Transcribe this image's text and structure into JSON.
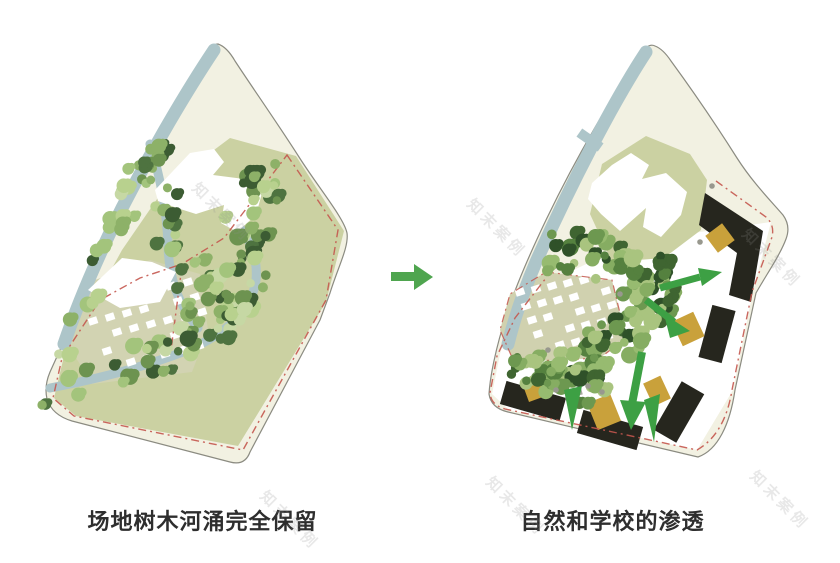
{
  "panels": {
    "left": {
      "caption": "场地树木河涌完全保留"
    },
    "right": {
      "caption": "自然和学校的渗透"
    }
  },
  "arrow": {
    "direction": "right"
  },
  "watermark": {
    "text": "知末案例"
  },
  "colors": {
    "site_fill": "#f2f1e2",
    "site_outline": "#8b8b81",
    "olive": "#cbd1a2",
    "village_ground_left": "#d2d3b2",
    "village_ground_right": "#d0d1af",
    "river": "#adc5c9",
    "building_white": "#ffffff",
    "building_black": "#26261e",
    "courtyard_gold": "#c9a13b",
    "boundary_red": "#c4574e",
    "arrow_green": "#4fa54f",
    "plan_arrow_green": "#3da044",
    "rock_gray": "#98988e",
    "caption_text": "#2e2e2e",
    "tree_palette_left": [
      "#b8d18e",
      "#a3c47c",
      "#8db168",
      "#6d9350",
      "#4e7340",
      "#3c5c33",
      "#c6d8a4"
    ],
    "tree_palette_right": [
      "#86ad62",
      "#6d9850",
      "#55813f",
      "#3f6531",
      "#97bb70",
      "#2f5129",
      "#a9c47f"
    ]
  }
}
